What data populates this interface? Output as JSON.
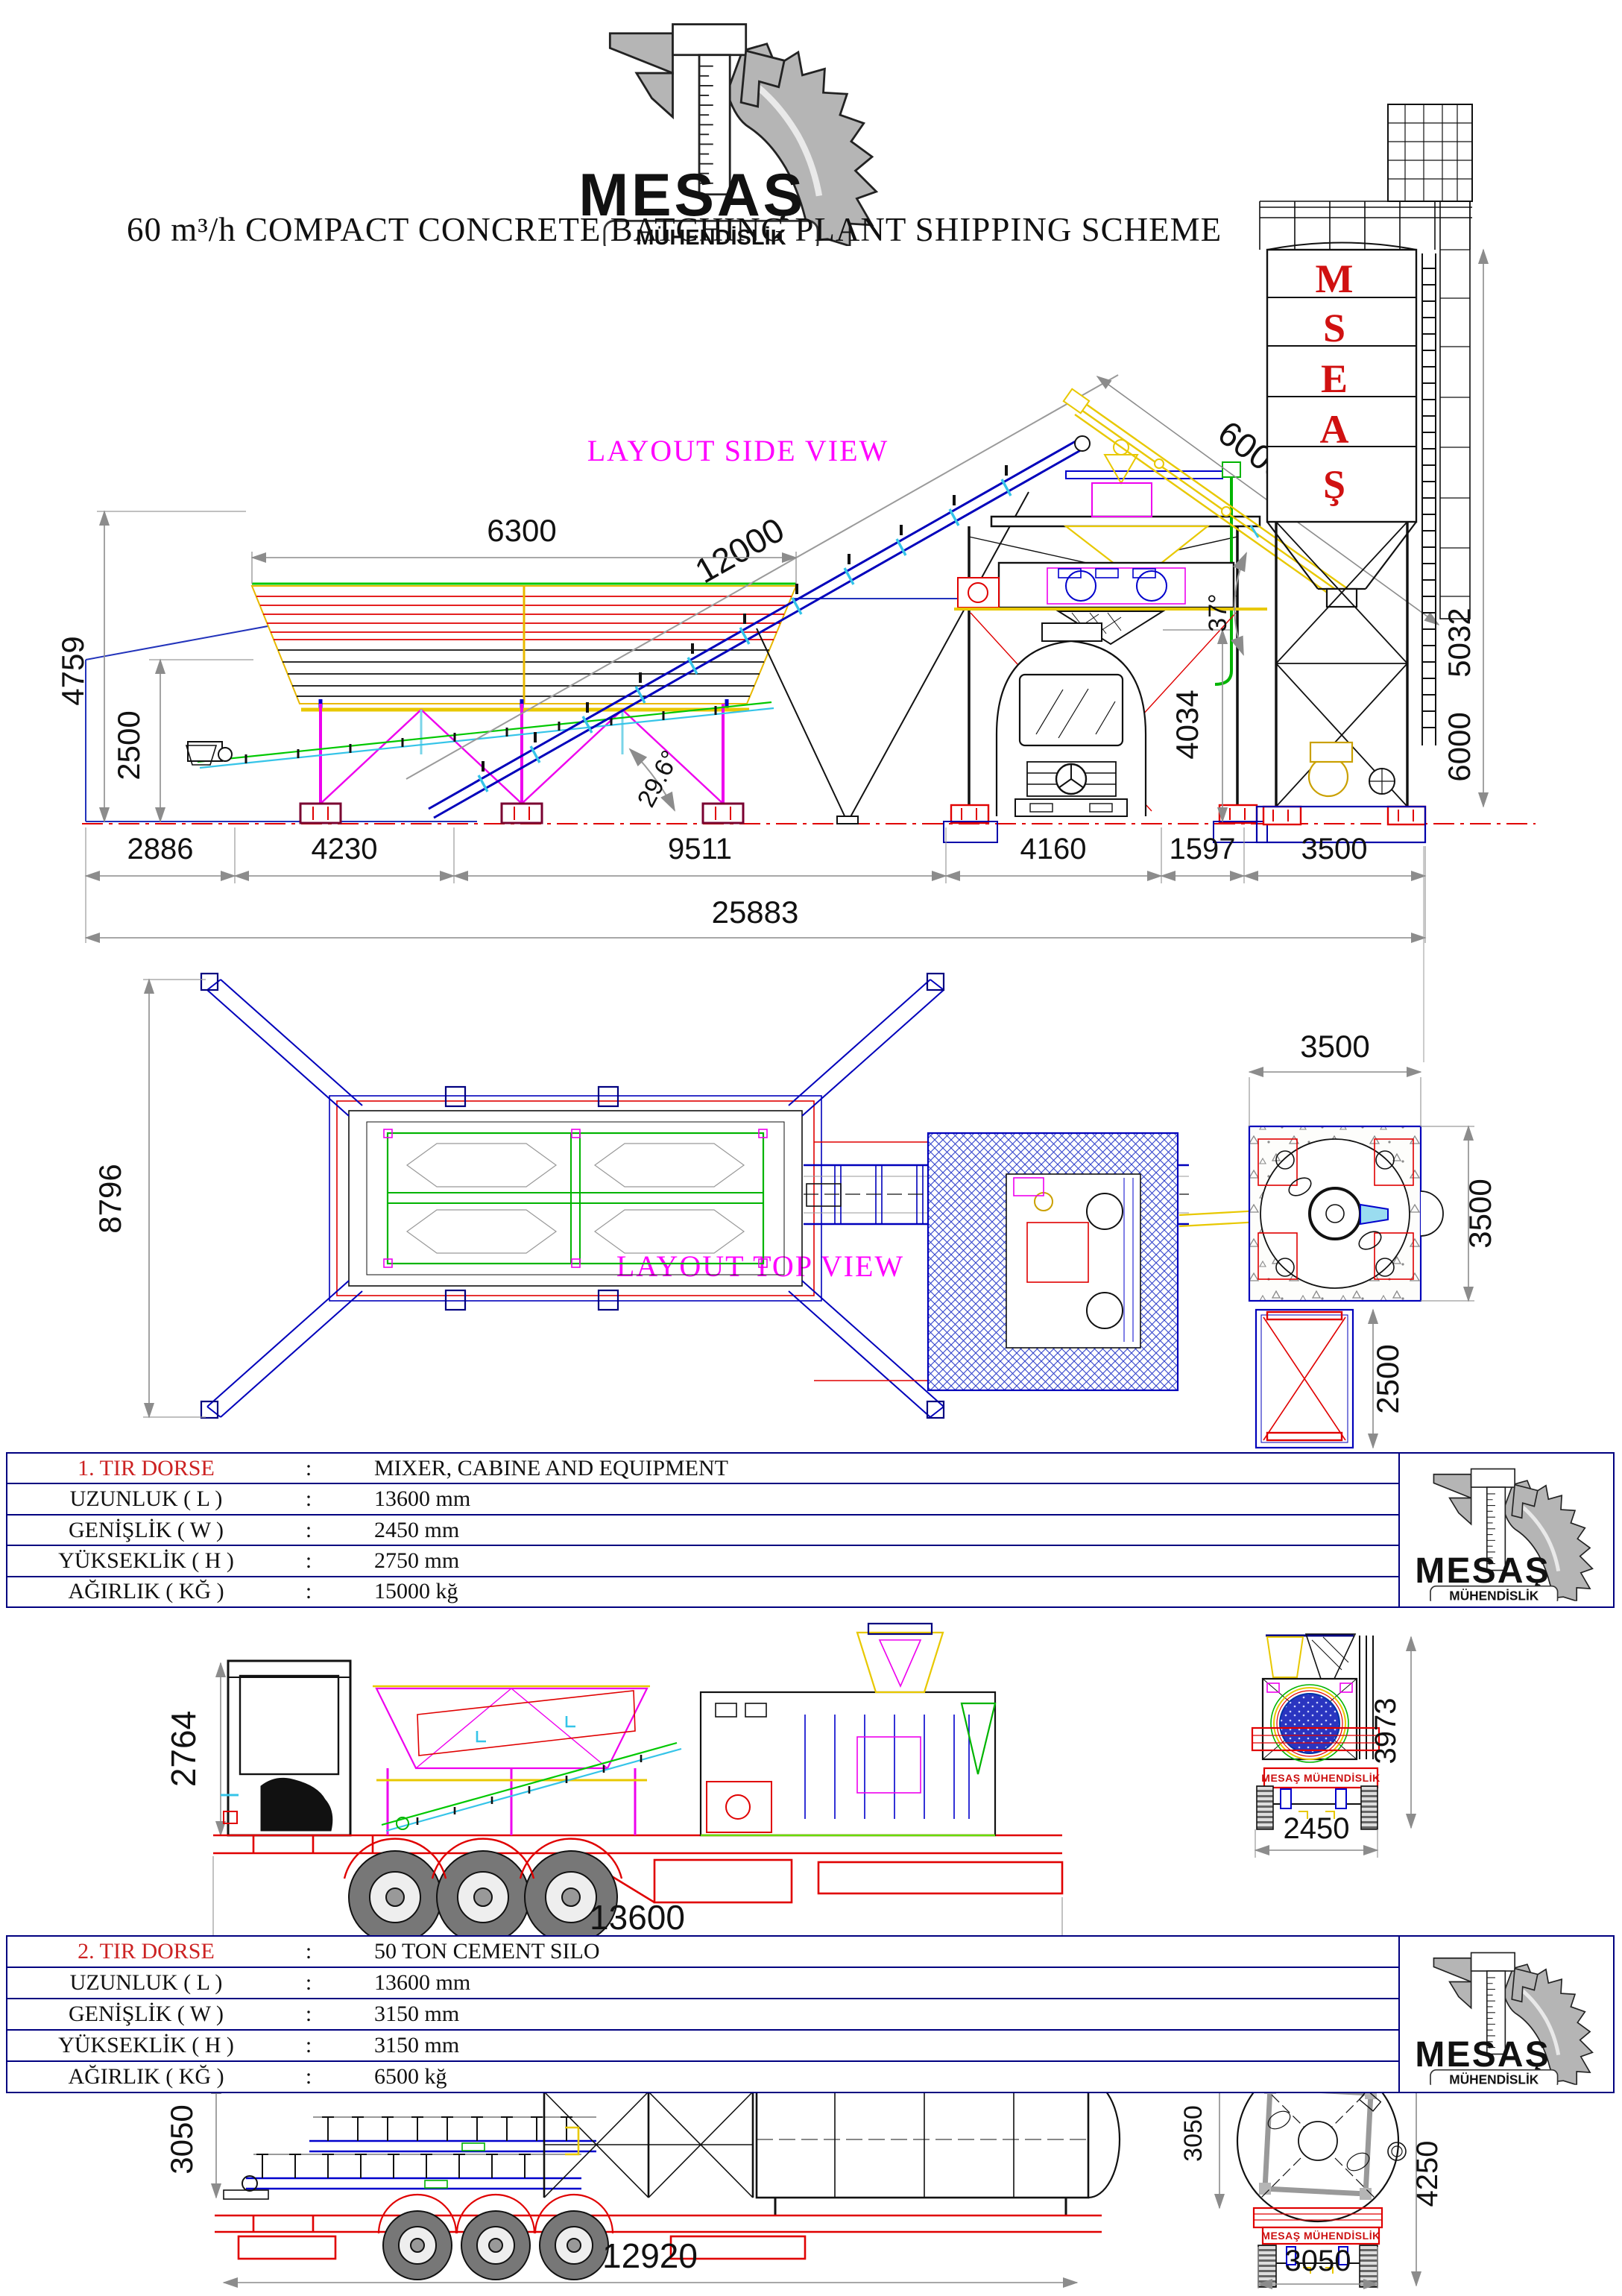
{
  "logo": {
    "name": "MESAŞ",
    "subtitle": "MÜHENDİSLİK"
  },
  "title": "60 m³/h COMPACT CONCRETE BATCHING PLANT SHIPPING SCHEME",
  "side_view": {
    "label": "LAYOUT SIDE VIEW",
    "silo_letters": [
      "M",
      "S",
      "E",
      "A",
      "Ş"
    ],
    "dims": {
      "bin_width": "6300",
      "conveyor_length": "12000",
      "conveyor_angle": "29.6°",
      "screw_length": "6000",
      "screw_angle": "37°",
      "mixer_clearance": "4034",
      "silo_dim_upper": "5032",
      "silo_dim_lower": "6000",
      "pit_height": "4759",
      "pit_depth": "2500",
      "chain": [
        "2886",
        "4230",
        "9511",
        "4160",
        "1597",
        "3500"
      ],
      "total_length": "25883"
    }
  },
  "top_view": {
    "label": "LAYOUT TOP VIEW",
    "dims": {
      "bin_depth": "8796",
      "pad_width": "3500",
      "pad_depth": "3500",
      "cabin_width": "2500"
    }
  },
  "table1": {
    "title_label": "1. TIR DORSE",
    "colon": ":",
    "title_value": "MIXER, CABINE AND EQUIPMENT",
    "rows": [
      {
        "label": "UZUNLUK ( L )",
        "value": "13600 mm"
      },
      {
        "label": "GENİŞLİK ( W )",
        "value": "2450 mm"
      },
      {
        "label": "YÜKSEKLİK ( H )",
        "value": "2750 mm"
      },
      {
        "label": "AĞIRLIK ( KĞ )",
        "value": "15000 kğ"
      }
    ]
  },
  "truck1": {
    "banner": "MESAŞ MÜHENDİSLİK",
    "dims": {
      "load_height": "2764",
      "length": "13600",
      "rear_height": "3973",
      "rear_width": "2450"
    }
  },
  "table2": {
    "title_label": "2. TIR DORSE",
    "colon": ":",
    "title_value": "50 TON CEMENT SILO",
    "rows": [
      {
        "label": "UZUNLUK ( L )",
        "value": "13600 mm"
      },
      {
        "label": "GENİŞLİK ( W )",
        "value": "3150 mm"
      },
      {
        "label": "YÜKSEKLİK ( H )",
        "value": "3150 mm"
      },
      {
        "label": "AĞIRLIK ( KĞ )",
        "value": "6500 kğ"
      }
    ]
  },
  "truck2": {
    "banner": "MESAŞ MÜHENDİSLİK",
    "dims": {
      "load_height": "3050",
      "length": "12920",
      "rear_side": "3050",
      "rear_height": "4250",
      "rear_width": "3050"
    }
  }
}
